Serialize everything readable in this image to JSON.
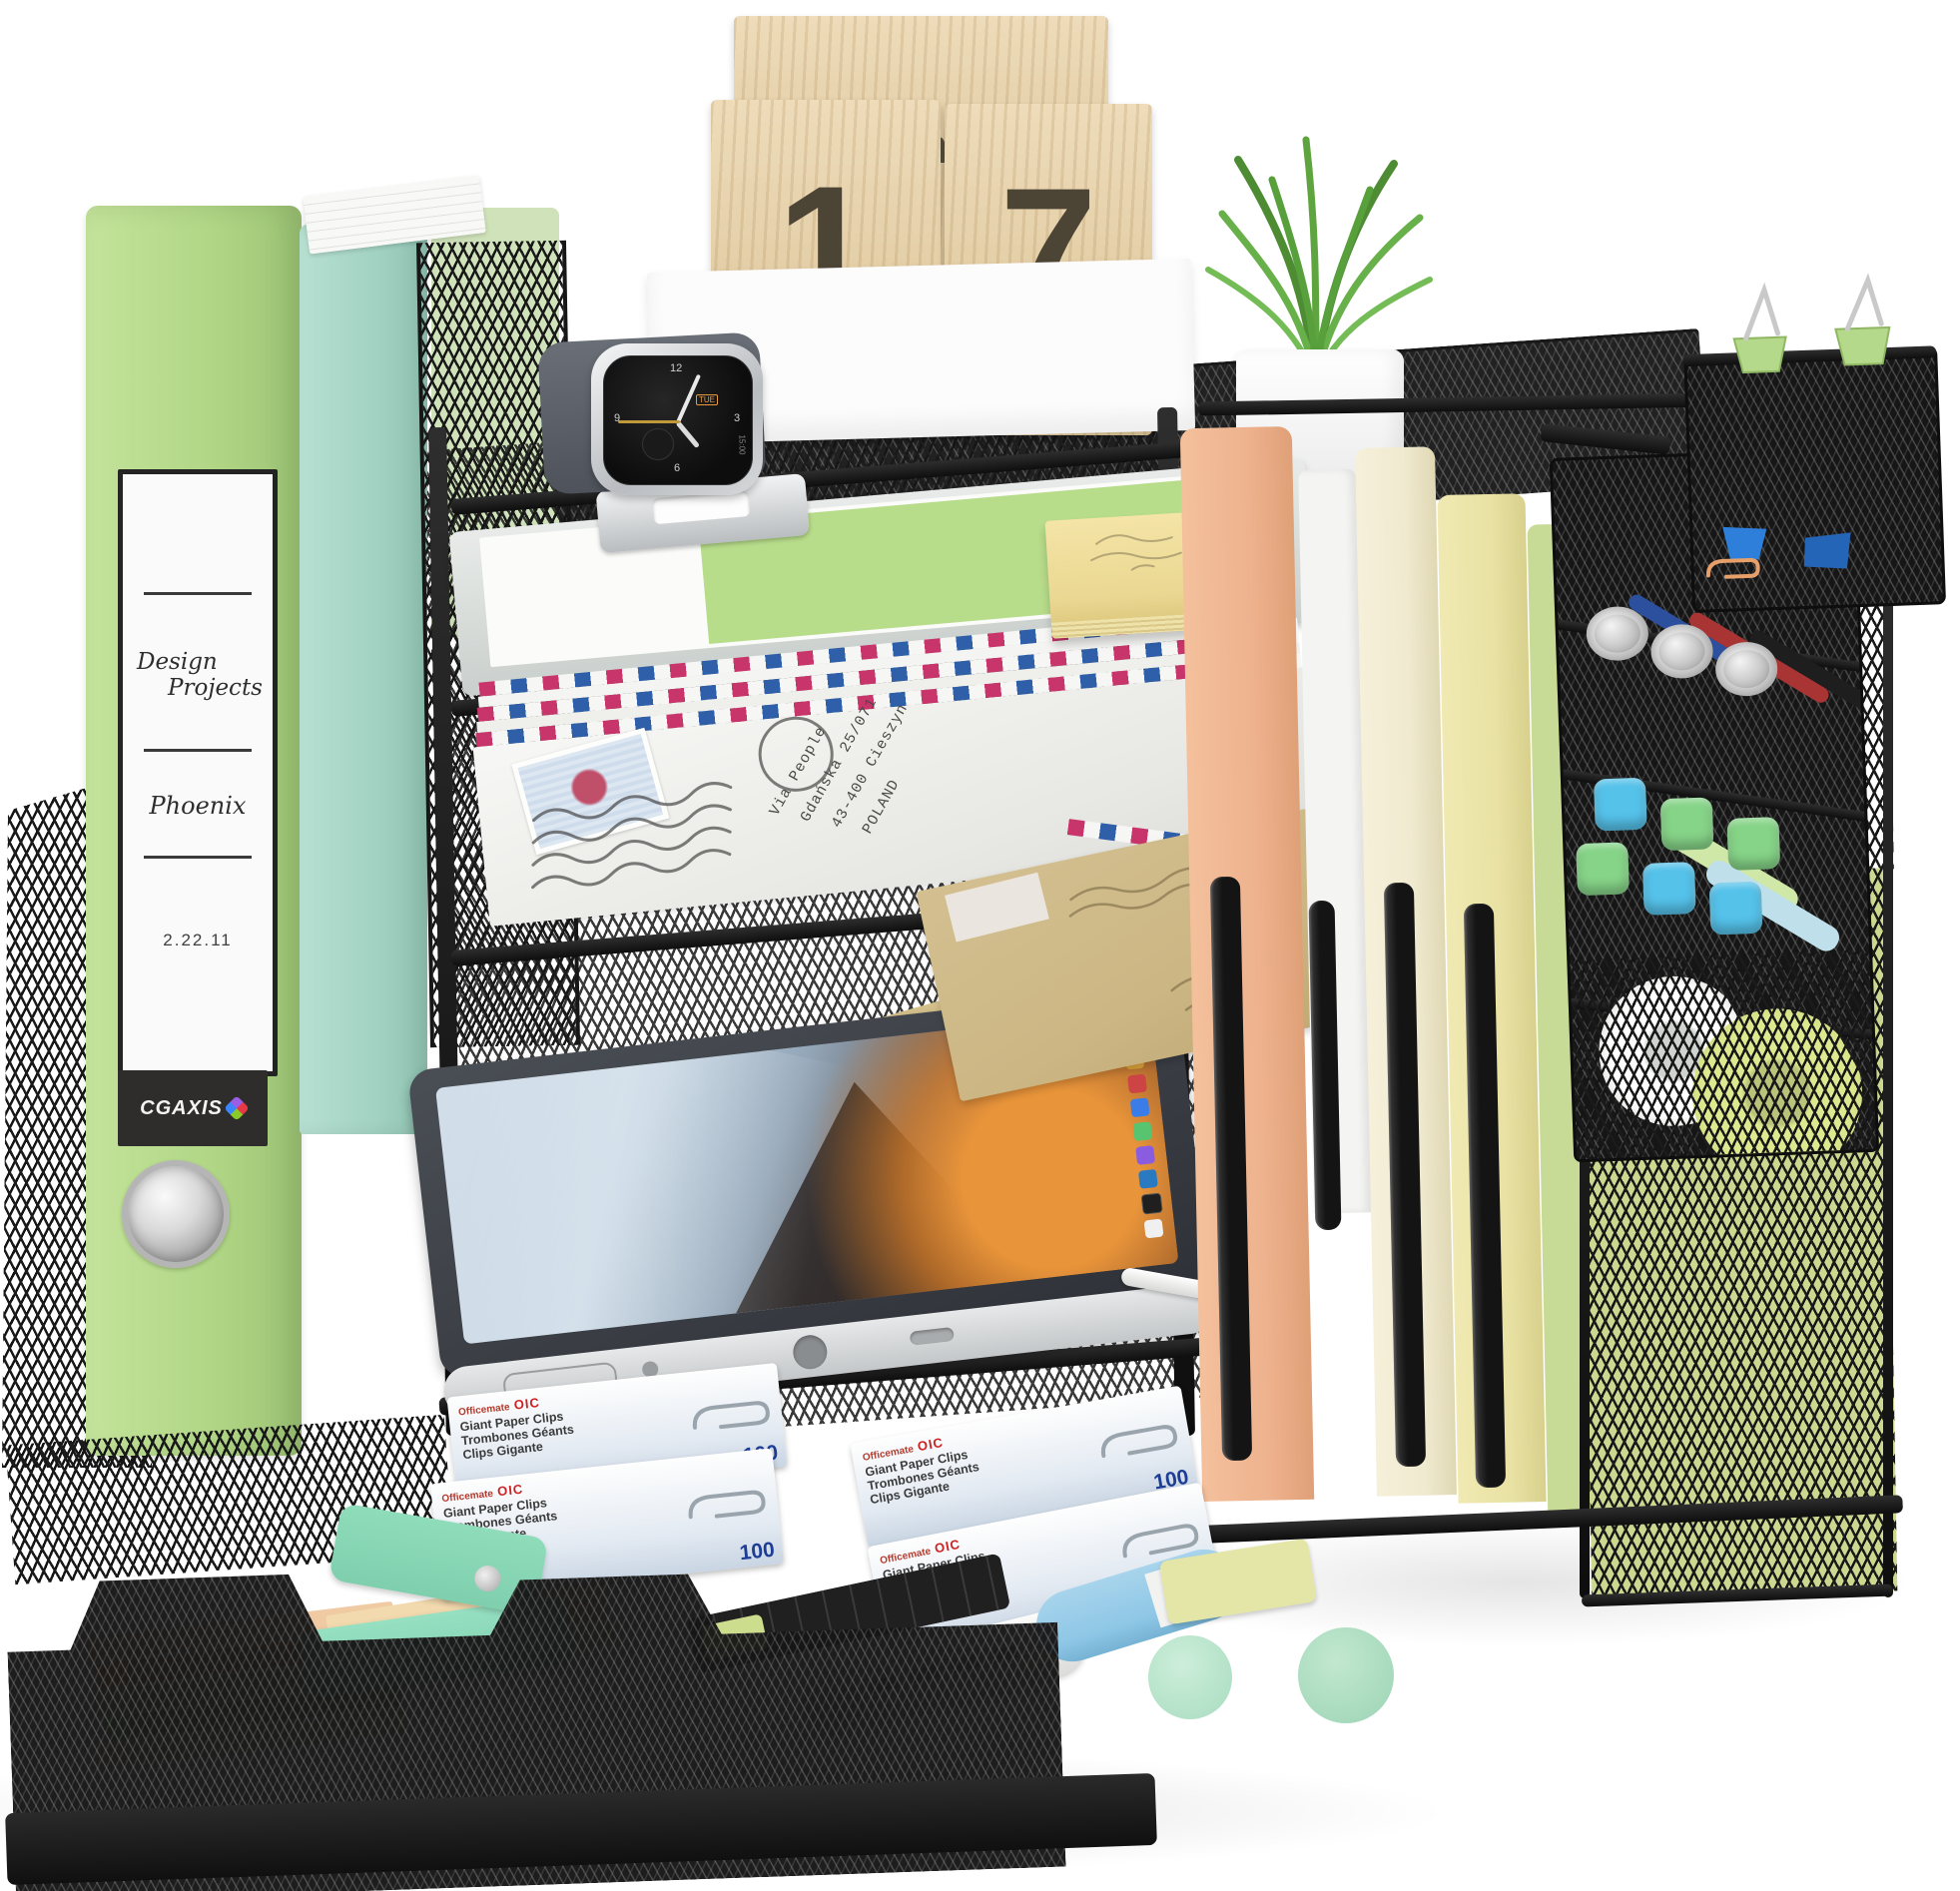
{
  "calendar": {
    "month": "November",
    "day_left": "1",
    "day_right": "7"
  },
  "binder_label": {
    "line1": "Design",
    "line2": "Projects",
    "line3": "Phoenix",
    "date": "2.22.11",
    "brand": "CGAXIS"
  },
  "watch": {
    "day": "TUE",
    "time": "15:00",
    "marks": [
      "12",
      "3",
      "6",
      "9"
    ]
  },
  "envelope_address": {
    "line1": "Via People",
    "line2": "Gdańska 25/071",
    "line3": "43-400 Cieszyn",
    "line4": "POLAND"
  },
  "clip_box": {
    "brand_prefix": "Officemate",
    "brand_short": "OIC",
    "line1": "Giant Paper Clips",
    "line2": "Trombones Géants",
    "line3": "Clips Gigante",
    "quantity": "100"
  },
  "colors": {
    "mesh": "#161616",
    "binderGreen": "#b2d787",
    "binderTeal": "#a2d2c2",
    "folderPeach": "#eeb28e",
    "folderWhite": "#f4f4f2",
    "folderCream": "#f0ead0",
    "folderYellow": "#e9e2a4",
    "folderGreen": "#c8db96",
    "wood": "#e7ce9f",
    "plantGreen": "#5f9e3f",
    "stickyYellow": "#f0dd96",
    "mint": "#84d4b4",
    "kraft": "#ccb684",
    "stripeRed": "#c8356b",
    "stripeBlue": "#2f5fa8",
    "capBlue": "#55c2ea",
    "capGreen": "#86d488",
    "qtyBlue": "#1d3e95",
    "brandRed": "#cc2222",
    "screenOrange": "#e8943a"
  }
}
